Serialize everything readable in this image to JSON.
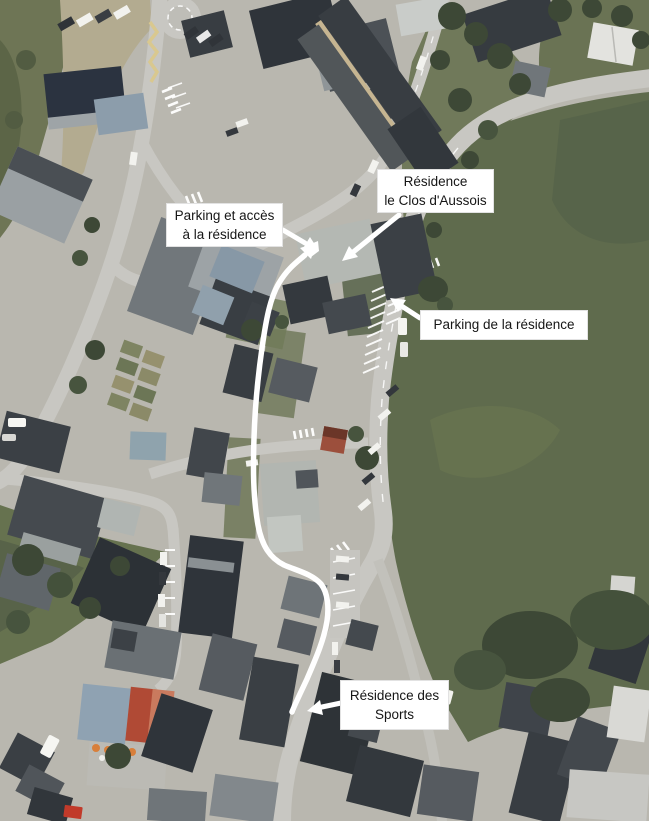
{
  "map": {
    "kind": "aerial-photo-with-route-annotations",
    "annotations": [
      {
        "id": "residence-le-clos-d-aussois",
        "line1": "Résidence",
        "line2": "le Clos d'Aussois"
      },
      {
        "id": "parking-et-acces",
        "line1": "Parking et accès",
        "line2": "à la résidence"
      },
      {
        "id": "parking-de-la-residence",
        "line1": "Parking de la résidence",
        "line2": ""
      },
      {
        "id": "residence-des-sports",
        "line1": "Résidence des",
        "line2": "Sports"
      }
    ],
    "overlay_colors": {
      "route_line": "#ffffff",
      "arrow": "#ffffff",
      "label_background": "#ffffff",
      "label_text": "#161616"
    },
    "terrain_colors": {
      "meadow_green": "#5f6b4d",
      "scrub_green": "#6e7555",
      "road_gray": "#c8c7c2",
      "paved_gray": "#b9b7af",
      "building_dark_gray": "#33383d",
      "building_light_gray": "#aeb3b6",
      "roof_blue_gray": "#8c9dab",
      "roof_red": "#b04a35",
      "roof_orange": "#c97a5e"
    }
  }
}
